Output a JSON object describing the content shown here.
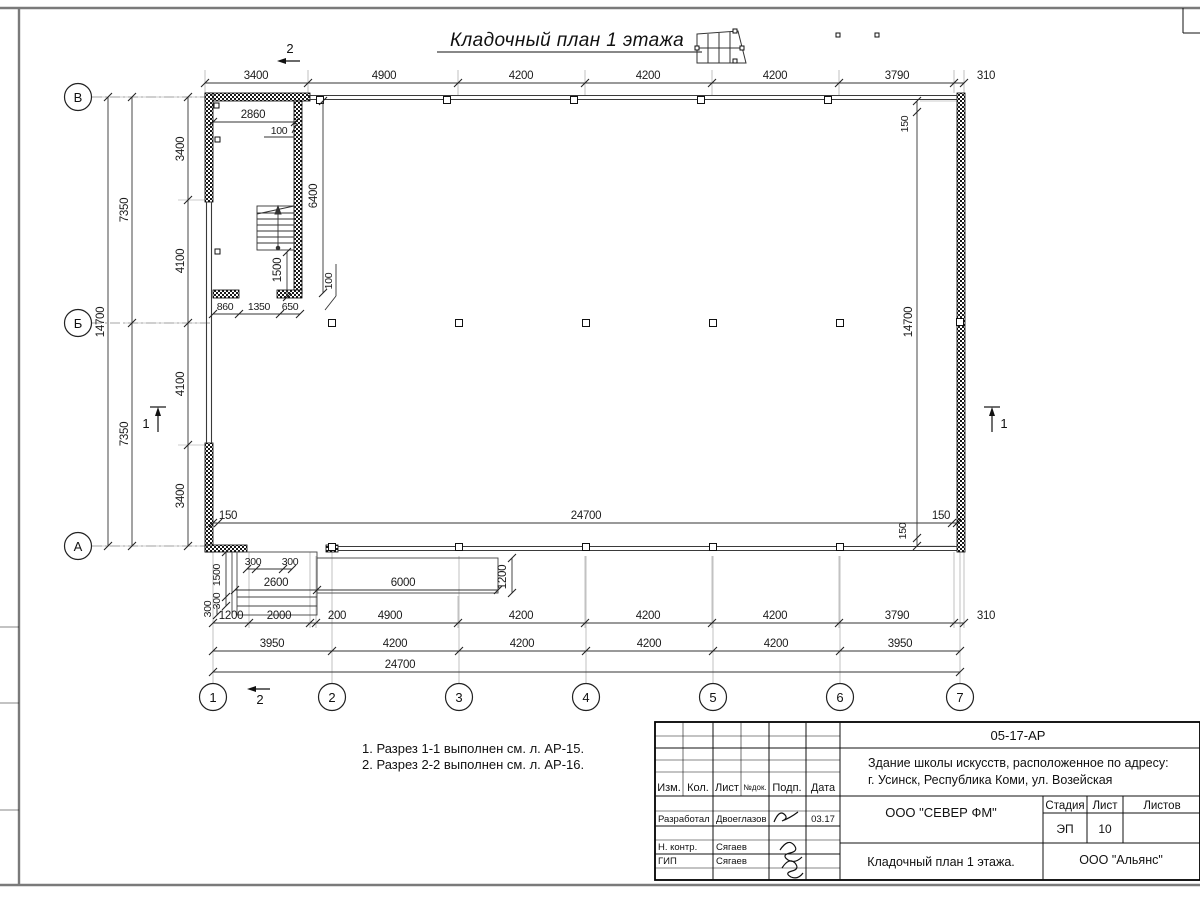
{
  "sheet": {
    "title": "Кладочный план 1 этажа"
  },
  "grid": {
    "row_labels": [
      "В",
      "Б",
      "А"
    ],
    "col_labels": [
      "1",
      "2",
      "3",
      "4",
      "5",
      "6",
      "7"
    ]
  },
  "section_marks": {
    "one": "1",
    "two": "2"
  },
  "dims": {
    "top": [
      "3400",
      "4900",
      "4200",
      "4200",
      "4200",
      "3790",
      "310"
    ],
    "left": {
      "overall": "14700",
      "halves": [
        "7350",
        "7350"
      ],
      "inner": [
        "3400",
        "4100",
        "4100",
        "3400"
      ]
    },
    "right": {
      "overall": "14700",
      "off_top": "150",
      "off_bottom": "150"
    },
    "inner_row": [
      "150",
      "24700",
      "150"
    ],
    "interior": {
      "w2860": "2860",
      "n100a": "100",
      "h6400": "6400",
      "h1500": "1500",
      "n100b": "100",
      "d860": "860",
      "d1350": "1350",
      "d650": "650"
    },
    "porch": {
      "s300a": "300",
      "s300b": "300",
      "w2600": "2600",
      "w6000": "6000",
      "d1200": "1200",
      "v1500": "1500",
      "v300a": "300",
      "v300b": "300"
    },
    "bottom1": [
      "1200",
      "2000",
      "200",
      "4900",
      "4200",
      "4200",
      "4200",
      "3790",
      "310"
    ],
    "bottom2": [
      "3950",
      "4200",
      "4200",
      "4200",
      "4200",
      "3950"
    ],
    "bottom3": "24700"
  },
  "notes": {
    "line1": "1. Разрез 1-1 выполнен см. л. АР-15.",
    "line2": "2. Разрез 2-2 выполнен см. л. АР-16."
  },
  "titleblock": {
    "doc_code": "05-17-АР",
    "project_address_line1": "Здание школы искусств, расположенное по адресу:",
    "project_address_line2": "г. Усинск, Республика Коми, ул. Возейская",
    "columns": [
      "Изм.",
      "Кол.",
      "Лист",
      "№док.",
      "Подп.",
      "Дата"
    ],
    "rows": [
      {
        "role": "Разработал",
        "name": "Двоеглазов",
        "date": "03.17"
      },
      {
        "role": "Н. контр.",
        "name": "Сягаев",
        "date": ""
      },
      {
        "role": "ГИП",
        "name": "Сягаев",
        "date": ""
      }
    ],
    "design_org": "ООО \"СЕВЕР ФМ\"",
    "stage_label": "Стадия",
    "sheet_label": "Лист",
    "sheets_label": "Листов",
    "stage": "ЭП",
    "sheet_no": "10",
    "drawing_name": "Кладочный план 1 этажа.",
    "client_org": "ООО \"Альянс\""
  }
}
